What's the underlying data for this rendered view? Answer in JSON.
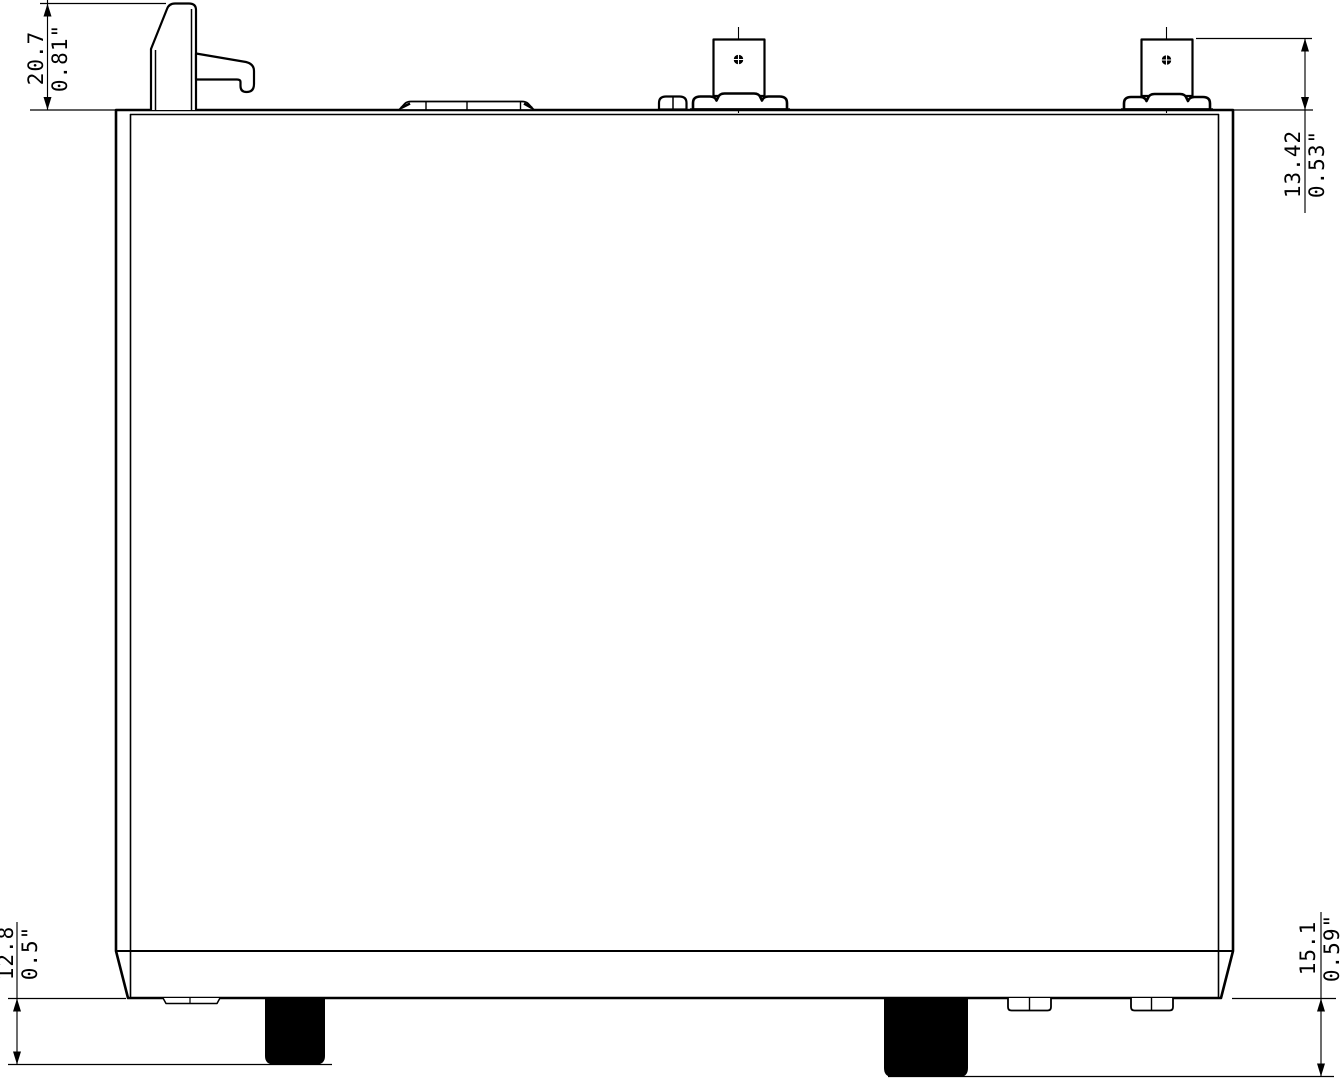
{
  "drawing": {
    "kind": "device-side-view-dimension-drawing",
    "background_color": "#ffffff",
    "line_color": "#000000",
    "foot_color": "#000000",
    "dimensions": {
      "top_left": {
        "metric": "20.7",
        "imperial": "0.81\""
      },
      "top_right": {
        "metric": "13.42",
        "imperial": "0.53\""
      },
      "bottom_left": {
        "metric": "12.8",
        "imperial": "0.5\""
      },
      "bottom_right": {
        "metric": "15.1",
        "imperial": "0.59\""
      }
    }
  }
}
